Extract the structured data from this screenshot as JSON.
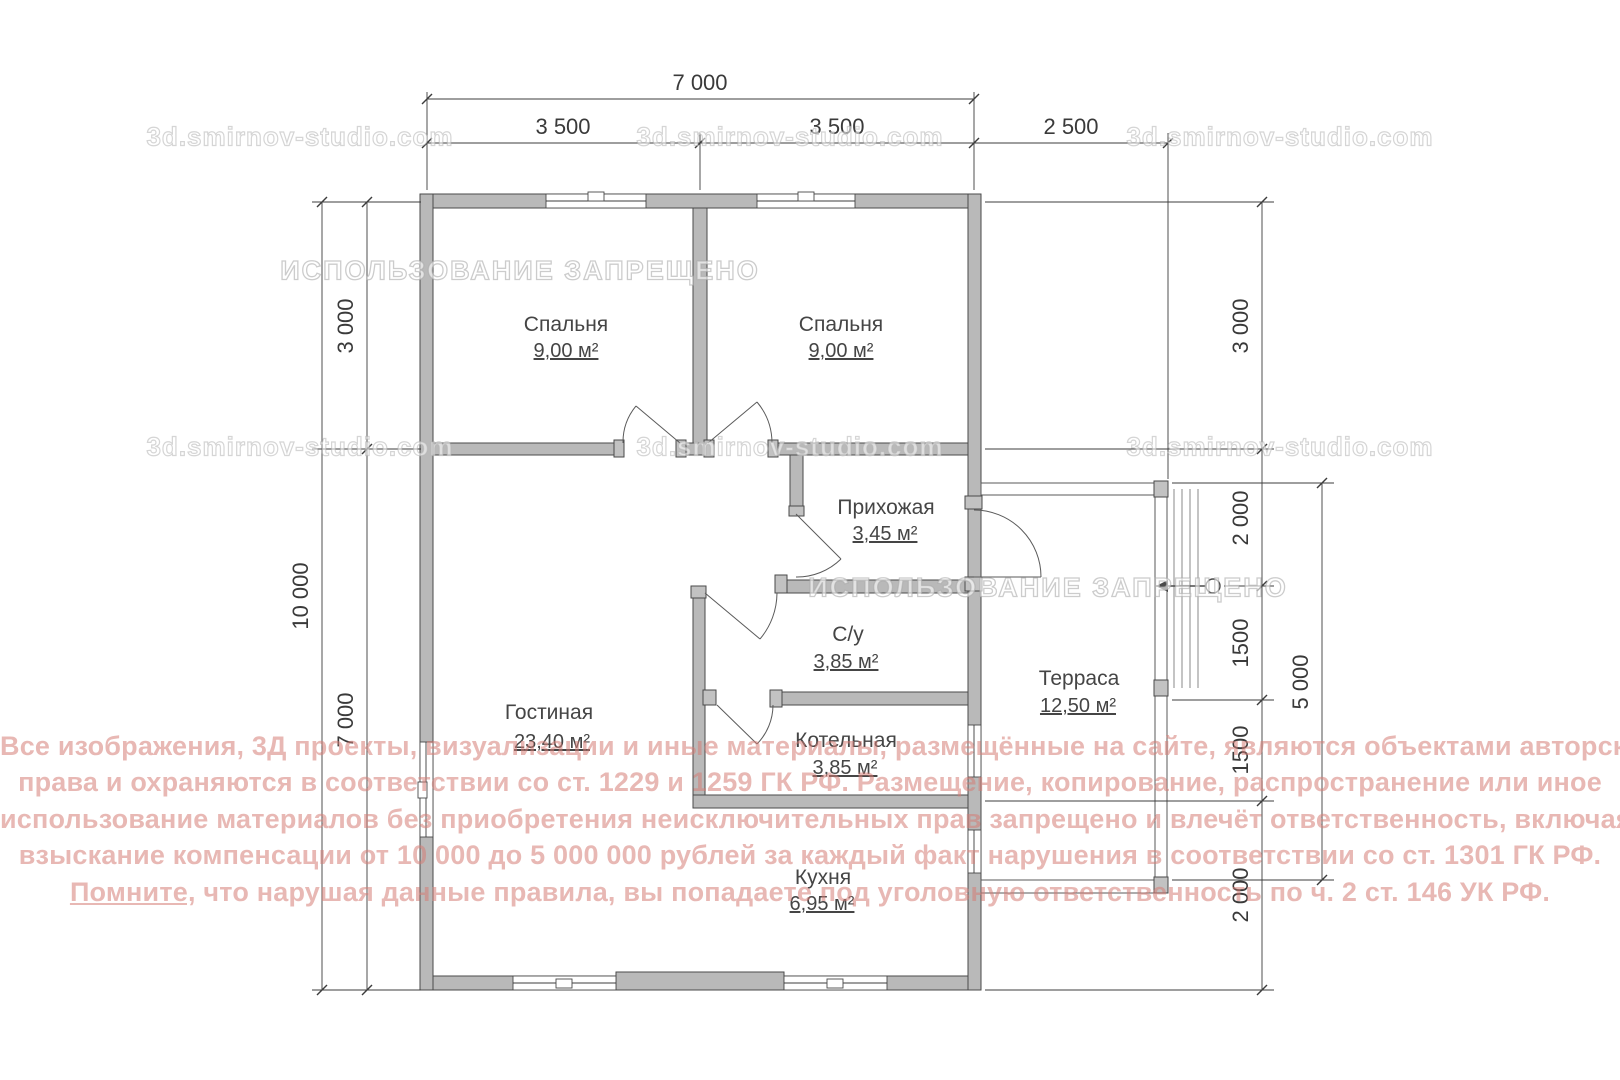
{
  "plan": {
    "rooms": {
      "bedroom1": {
        "name": "Спальня",
        "area": "9,00 м²"
      },
      "bedroom2": {
        "name": "Спальня",
        "area": "9,00 м²"
      },
      "hallway": {
        "name": "Прихожая",
        "area": "3,45 м²"
      },
      "bathroom": {
        "name": "С/у",
        "area": "3,85 м²"
      },
      "boiler": {
        "name": "Котельная",
        "area": "3,85 м²"
      },
      "living": {
        "name": "Гостиная",
        "area": "23,40 м²"
      },
      "kitchen": {
        "name": "Кухня",
        "area": "6,95 м²"
      },
      "terrace": {
        "name": "Терраса",
        "area": "12,50 м²"
      }
    },
    "dimensions": {
      "top_total": "7 000",
      "top_left": "3 500",
      "top_right": "3 500",
      "top_terrace": "2 500",
      "left_total": "10 000",
      "left_top": "3 000",
      "left_bottom": "7 000",
      "right_1": "3 000",
      "right_2": "2 000",
      "right_3": "1500",
      "right_4": "1500",
      "right_5": "2 000",
      "terrace_side": "5 000"
    },
    "colors": {
      "wall_fill": "#b9b9b9",
      "line": "#4a4a4a",
      "legal_text": "#d67d76"
    }
  },
  "watermarks": {
    "site": "3d.smirnov-studio.com",
    "banner": "ИСПОЛЬЗОВАНИЕ ЗАПРЕЩЕНО",
    "legal": {
      "line1": "Все изображения, 3Д проекты, визуализации и иные материалы, размещённые на сайте, являются объектами авторского",
      "line2": "права и охраняются в соответствии со ст. 1229 и 1259 ГК РФ. Размещение, копирование, распространение или иное",
      "line3": "использование материалов без приобретения неисключительных прав запрещено и влечёт ответственность, включая",
      "line4": "взыскание компенсации от 10 000 до 5 000 000 рублей за каждый факт нарушения в соответствии со ст. 1301 ГК РФ.",
      "line5_lead": "Помните,",
      "line5_rest": " что нарушая данные правила, вы попадаете под уголовную ответственность по ч. 2 ст. 146 УК РФ."
    }
  }
}
